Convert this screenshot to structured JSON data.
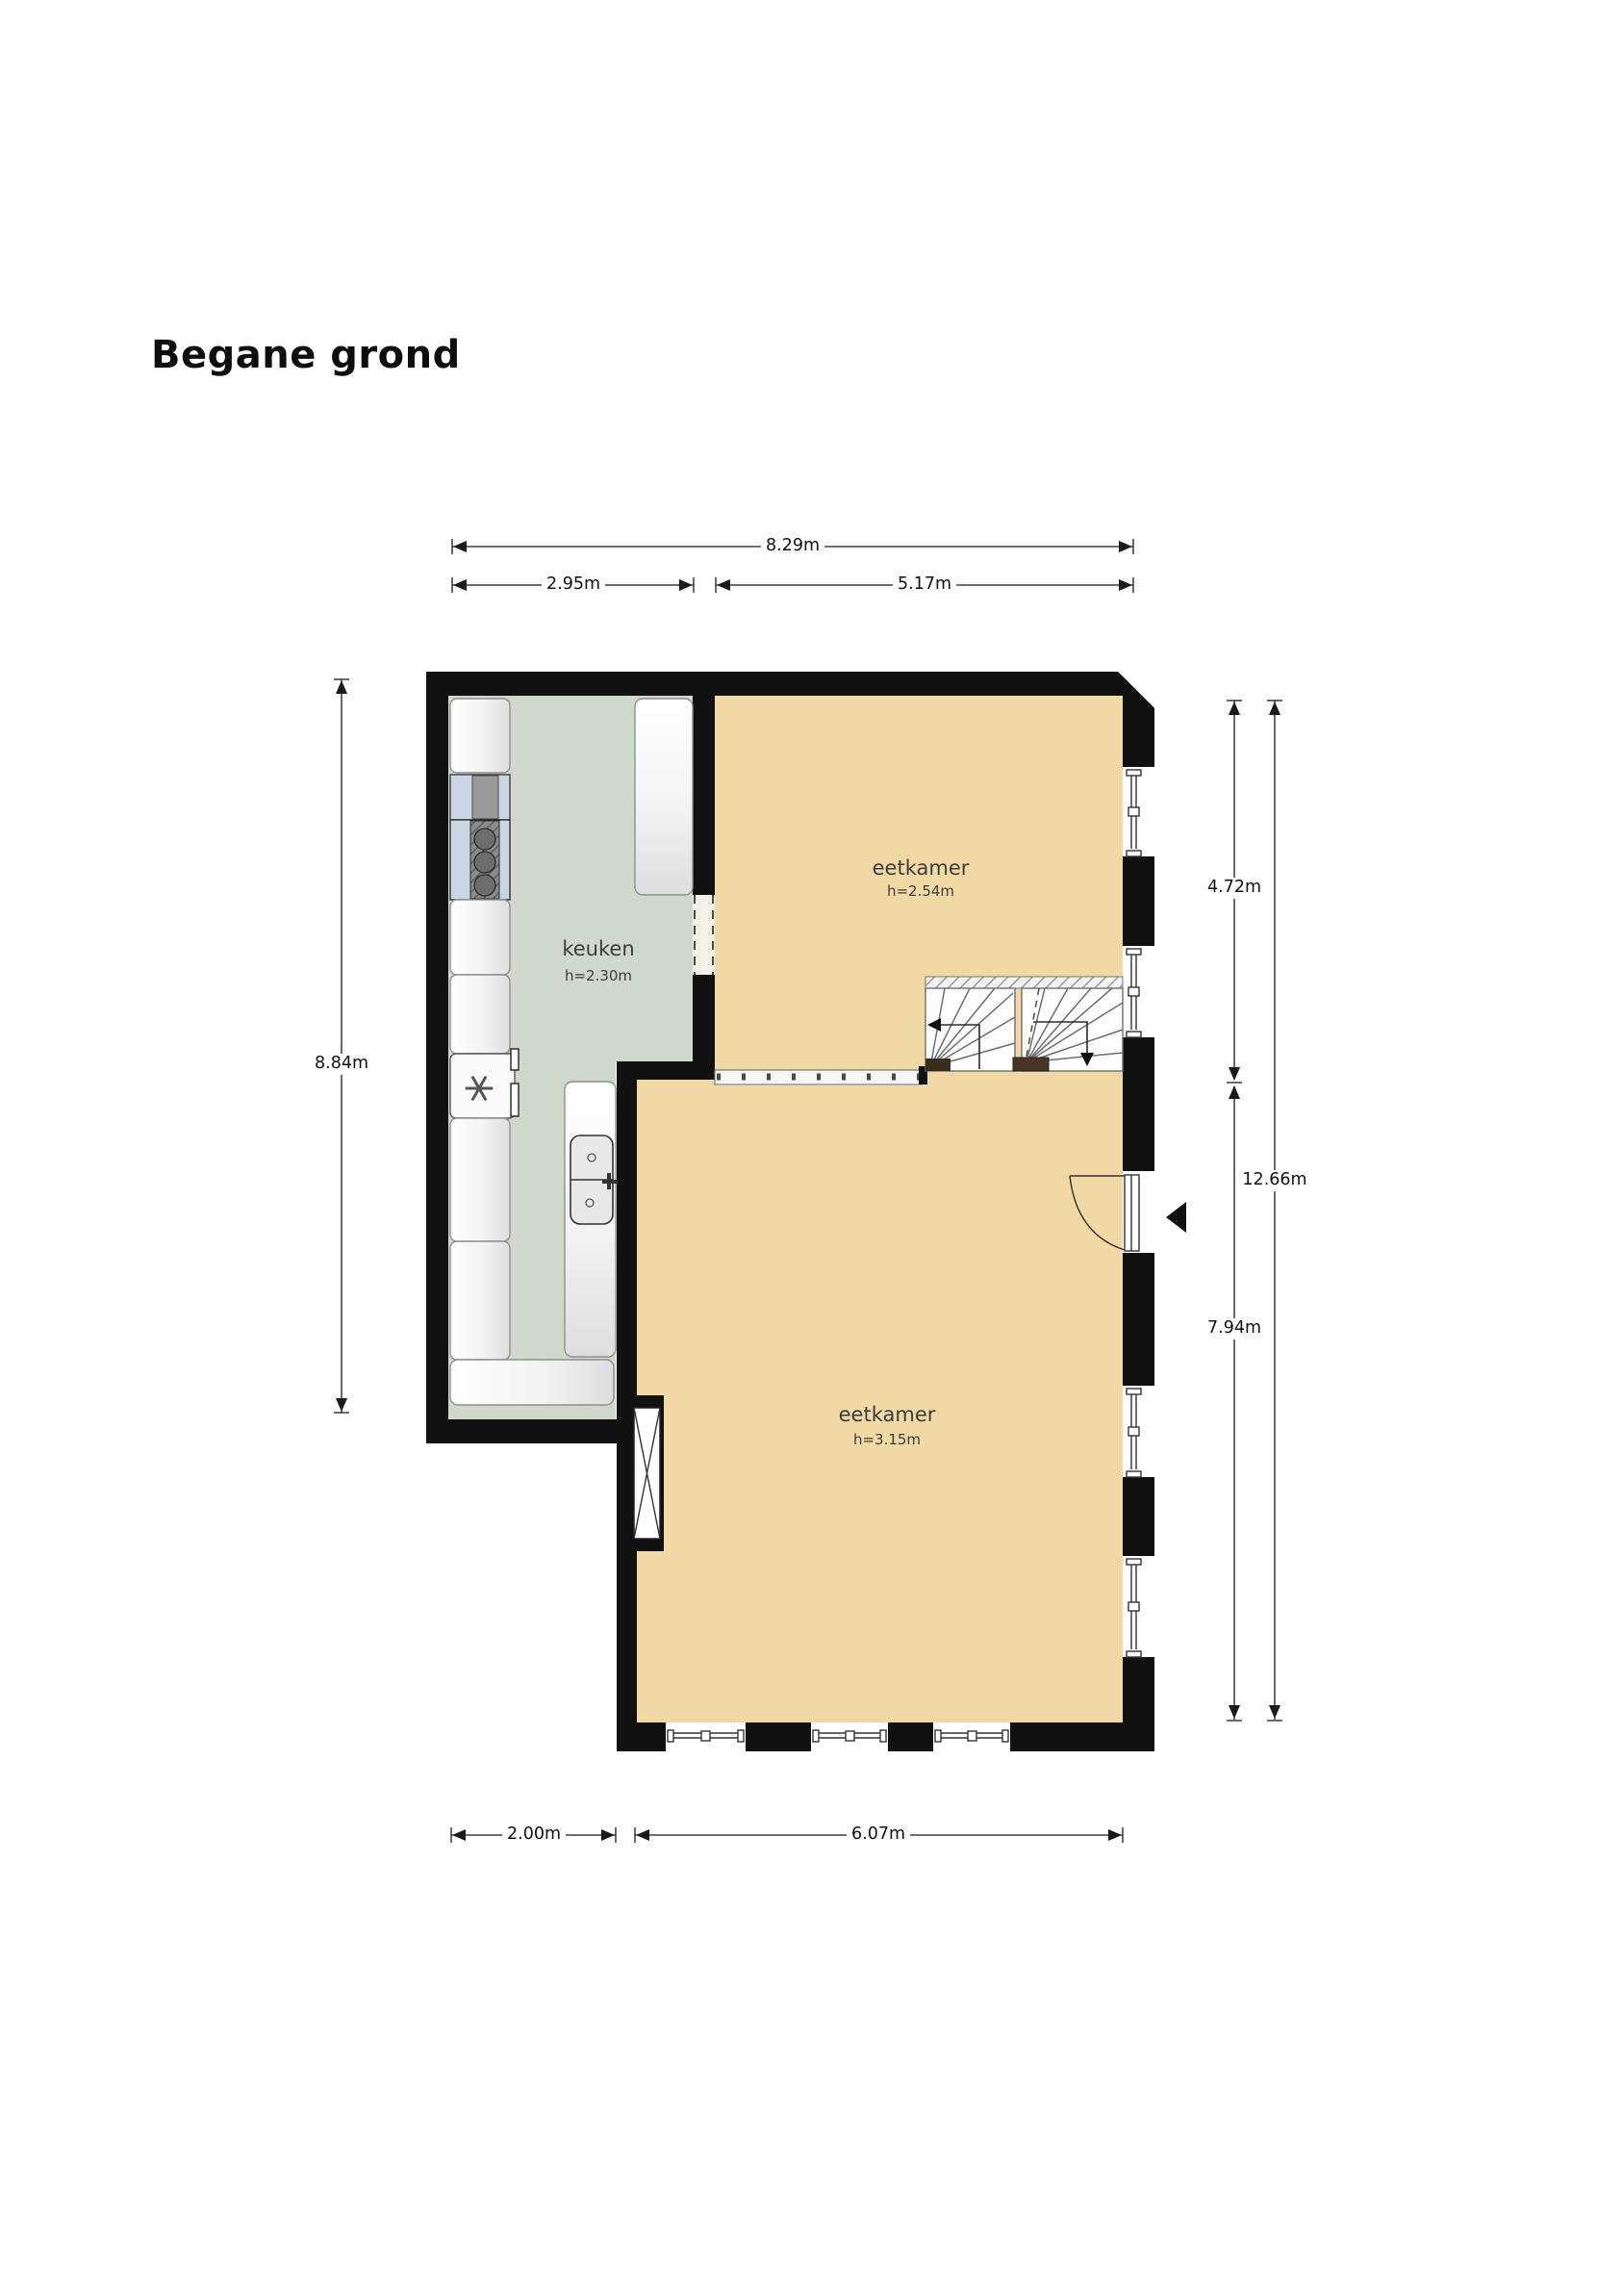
{
  "title": "Begane grond",
  "rooms": [
    {
      "name": "keuken",
      "ceiling": "h=2.30m"
    },
    {
      "name": "eetkamer",
      "ceiling": "h=2.54m"
    },
    {
      "name": "eetkamer",
      "ceiling": "h=3.15m"
    }
  ],
  "dimensions": {
    "width_total": "8.29m",
    "width_kitchen": "2.95m",
    "width_dining": "5.17m",
    "height_left": "8.84m",
    "height_right_upper": "4.72m",
    "height_right_total": "12.66m",
    "height_right_lower": "7.94m",
    "bottom_kitchen": "2.00m",
    "bottom_dining": "6.07m"
  },
  "colors": {
    "wall": "#111111",
    "floor_dining": "#f0d9a4",
    "floor_kitchen": "#cfd9cb",
    "dimline": "#1a1a1a"
  }
}
